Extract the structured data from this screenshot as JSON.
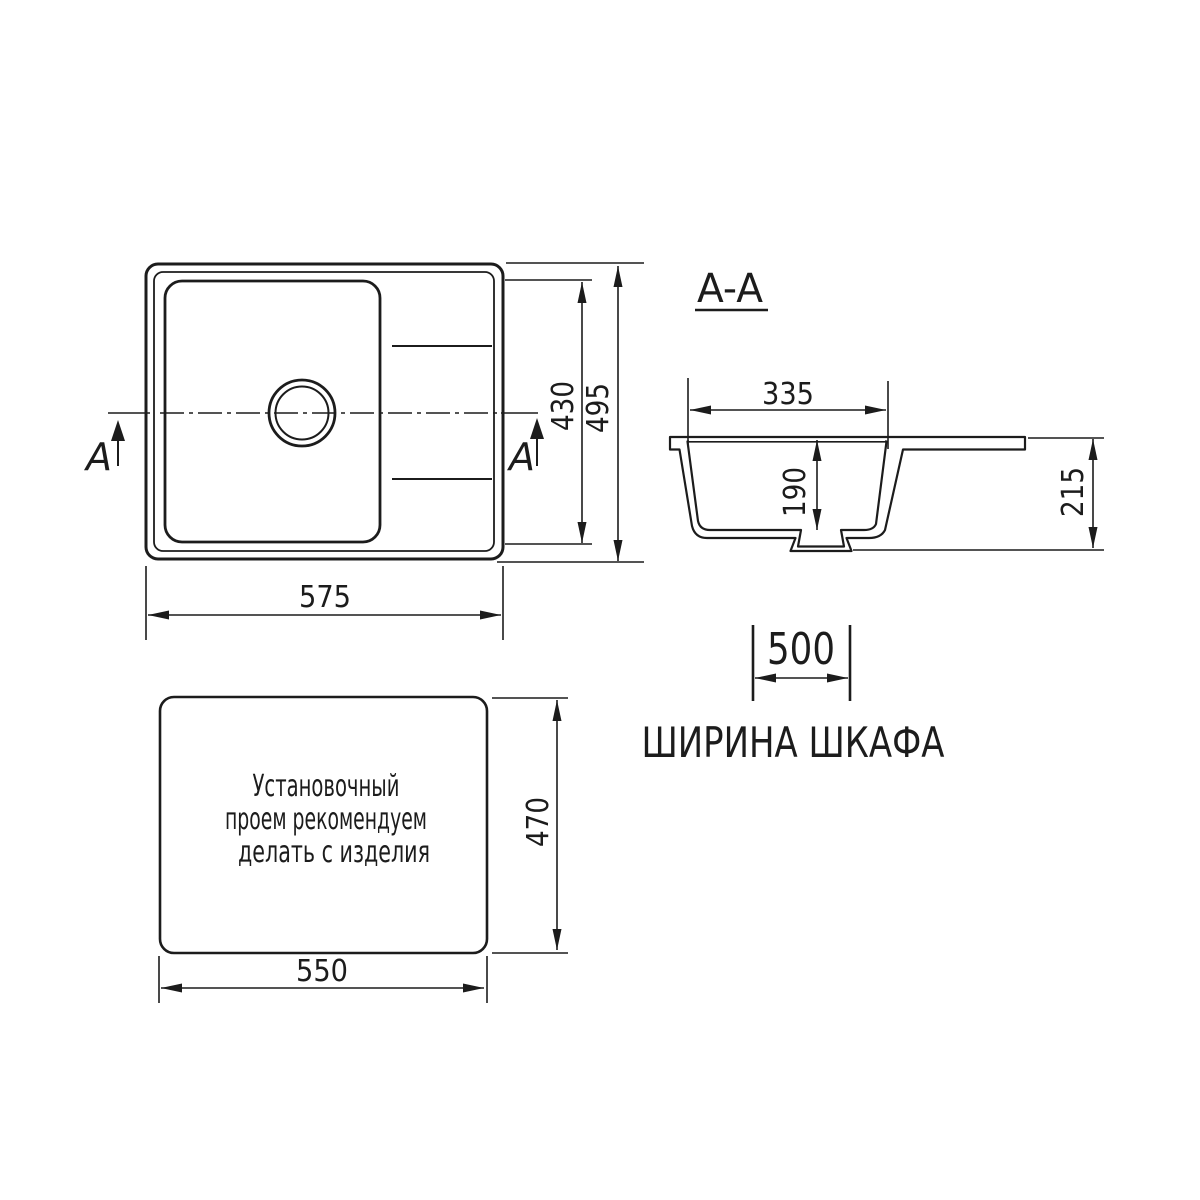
{
  "colors": {
    "background": "#ffffff",
    "line": "#1c1c1c"
  },
  "plan_view": {
    "section_marker": "A",
    "dim_width": "575",
    "dim_inner_height": "430",
    "dim_outer_height": "495"
  },
  "section_view": {
    "title": "A-A",
    "dim_bowl_width": "335",
    "dim_bowl_depth": "190",
    "dim_height": "215"
  },
  "cabinet": {
    "dim_width": "500",
    "label": "ШИРИНА ШКАФА"
  },
  "cutout_view": {
    "note_lines": [
      "Установочный",
      "проем рекомендуем",
      "делать с изделия"
    ],
    "dim_width": "550",
    "dim_height": "470"
  }
}
